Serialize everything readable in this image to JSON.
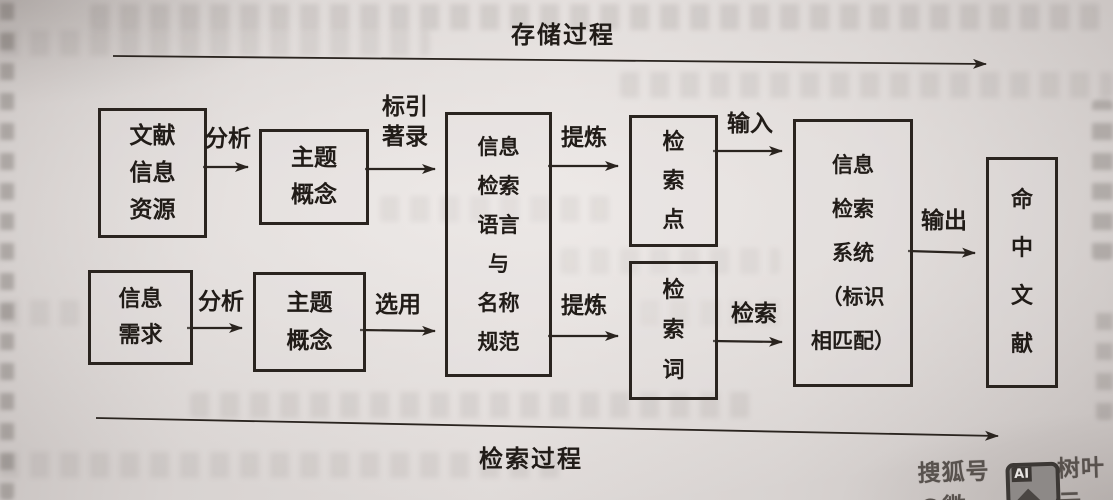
{
  "diagram": {
    "top_process_label": "存储过程",
    "bottom_process_label": "检索过程",
    "boxes": {
      "document_info_resources": "文献\n信息\n资源",
      "subject_concept_top": "主题\n概念",
      "retrieval_language": "信息\n检索\n语言\n与\n名称\n规范",
      "retrieval_point": "检\n索\n点",
      "retrieval_term": "检\n索\n词",
      "retrieval_system": "信息\n检索\n系统\n（标识\n相匹配）",
      "hit_documents": "命\n中\n文\n献",
      "info_need": "信息\n需求",
      "subject_concept_bottom": "主题\n概念"
    },
    "edge_labels": {
      "analyze_top": "分析",
      "indexing": "标引\n著录",
      "refine_top": "提炼",
      "input": "输入",
      "refine_bottom": "提炼",
      "search": "检索",
      "output": "输出",
      "analyze_bottom": "分析",
      "select": "选用"
    }
  },
  "watermark": {
    "prefix": "搜狐号@微",
    "badge": "AI",
    "suffix": "树叶云"
  },
  "colors": {
    "ink": "#2a241f",
    "paper": "#d9d3d1",
    "watermark_gray": "#544e4a"
  }
}
